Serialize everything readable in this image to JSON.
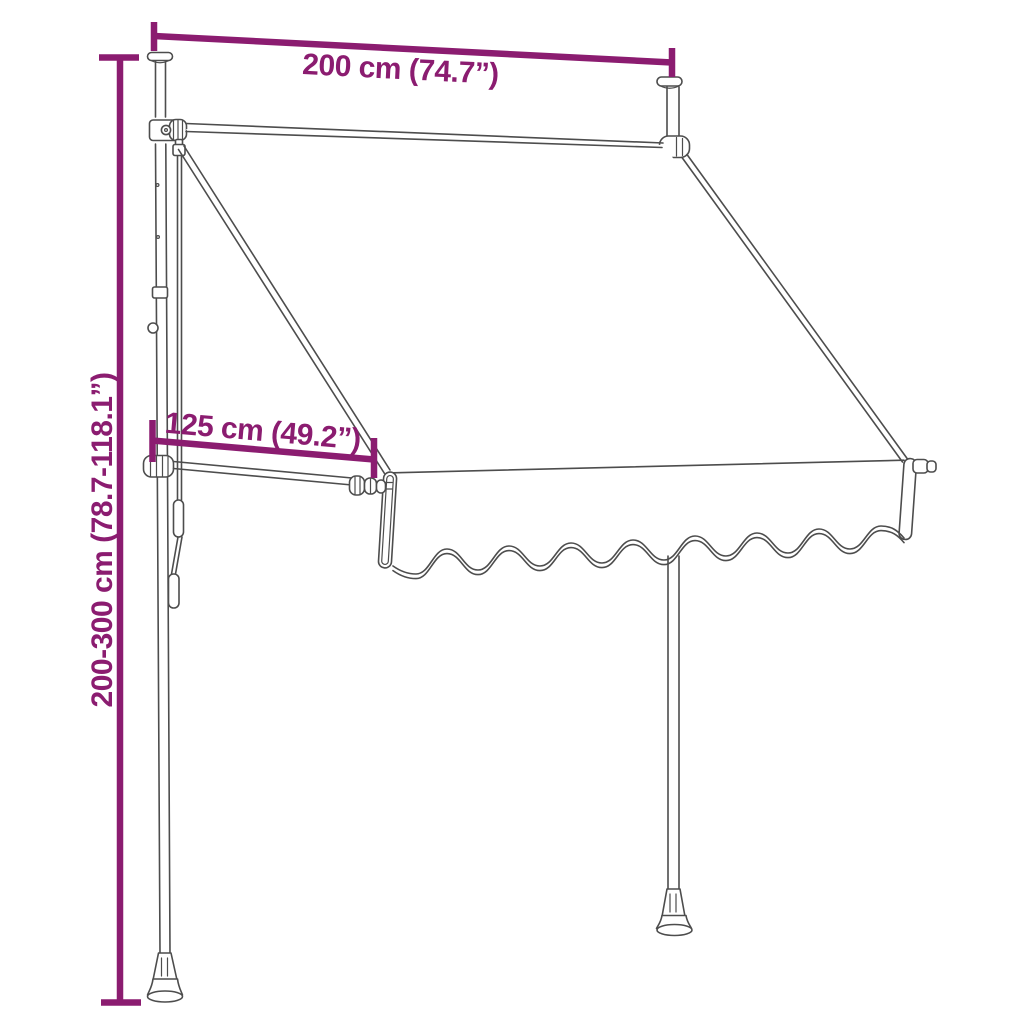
{
  "title": "Retractable awning with telescopic poles - dimension diagram",
  "colors": {
    "dimension": "#8b1c70",
    "lineart": "#4d4d4d",
    "background": "#ffffff"
  },
  "dimensions": {
    "width_label": "200 cm (74.7”)",
    "projection_label": "125 cm (49.2”)",
    "height_label": "200-300 cm (78.7-118.1”)"
  }
}
